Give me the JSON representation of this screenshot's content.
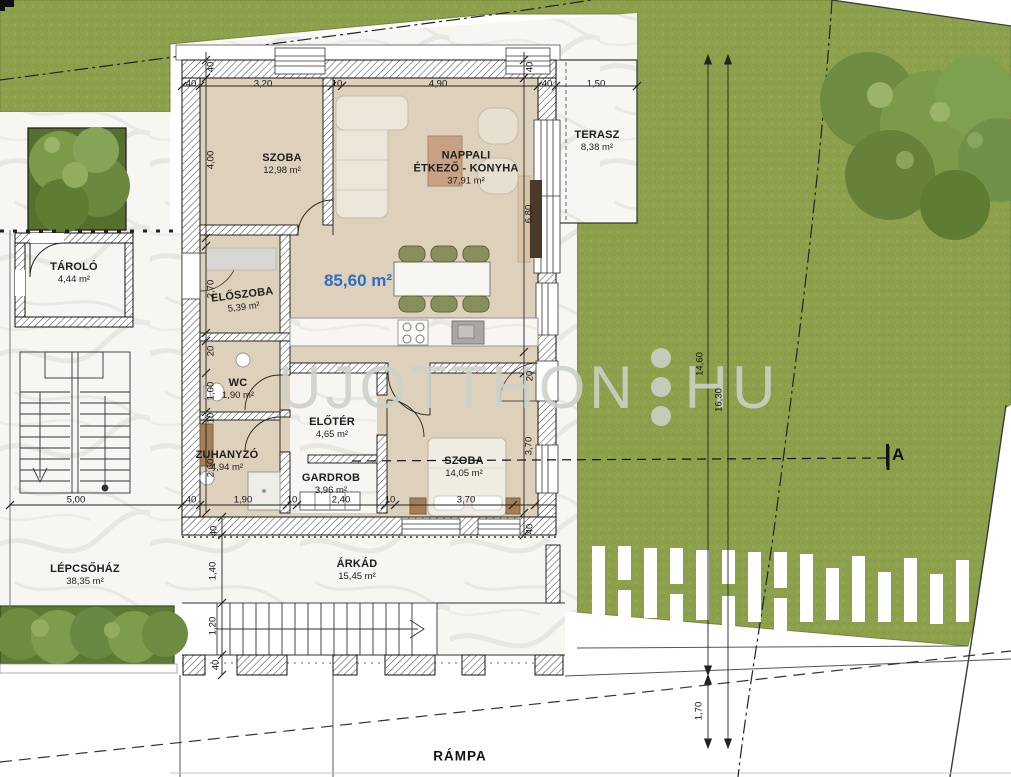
{
  "plan_title": "apartment floor plan",
  "total_area": "85,60 m²",
  "watermark": {
    "left": "UJOTTHON",
    "right": "HU"
  },
  "section_marker": "A",
  "rooms": {
    "szoba1": {
      "name": "SZOBA",
      "area": "12,98 m²"
    },
    "nappali": {
      "name1": "NAPPALI",
      "name2": "ÉTKEZŐ - KONYHA",
      "area": "37,91 m²"
    },
    "terasz": {
      "name": "TERASZ",
      "area": "8,38 m²"
    },
    "tarolo": {
      "name": "TÁROLÓ",
      "area": "4,44 m²"
    },
    "eloszoba": {
      "name": "ELŐSZOBA",
      "area": "5,39 m²"
    },
    "wc": {
      "name": "WC",
      "area": "1,90 m²"
    },
    "eloter": {
      "name": "ELŐTÉR",
      "area": "4,65 m²"
    },
    "zuhanyzo": {
      "name": "ZUHANYZÓ",
      "area": "4,94 m²"
    },
    "gardrob": {
      "name": "GARDROB",
      "area": "3,96 m²"
    },
    "szoba2": {
      "name": "SZOBA",
      "area": "14,05 m²"
    },
    "lepcsohaz": {
      "name": "LÉPCSŐHÁZ",
      "area": "38,35 m²"
    },
    "arkad": {
      "name": "ÁRKÁD",
      "area": "15,45 m²"
    },
    "rampa": {
      "name": "RÁMPA"
    }
  },
  "dims": [
    "40",
    "3,20",
    "10",
    "4,90",
    "40",
    "1,50",
    "40",
    "4,00",
    "2,70",
    "20",
    "1,00",
    "10",
    "2,60",
    "40",
    "1,90",
    "10",
    "2,40",
    "10",
    "3,70",
    "5,00",
    "40",
    "6,80",
    "20",
    "3,70",
    "40",
    "40",
    "1,40",
    "1,20",
    "40",
    "14,60",
    "16,30",
    "1,70"
  ],
  "colors": {
    "lawn": "#8da14c",
    "floor": "#ddd1bb",
    "accent_blue": "#2e6ec6",
    "hedge": "#5d7a33",
    "marble": "#f7f6f3"
  }
}
